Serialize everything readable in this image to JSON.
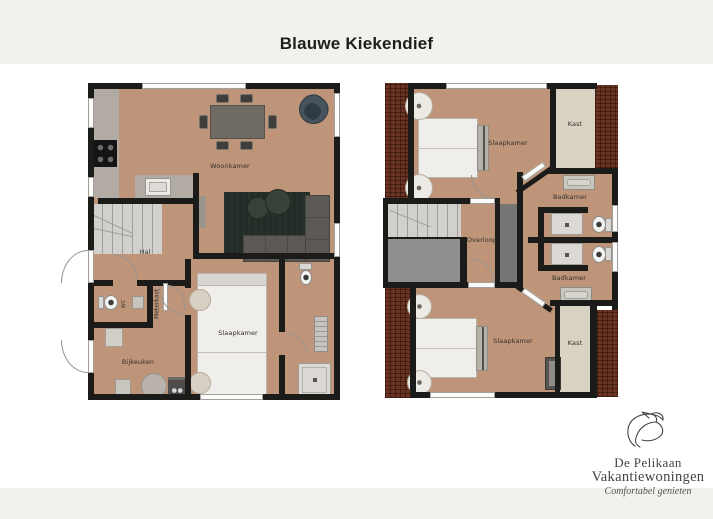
{
  "title": "Blauwe Kiekendief",
  "ground_floor": {
    "labels": {
      "woonkamer": "Woonkamer",
      "hal": "Hal",
      "wc": "WC",
      "meterkast": "Meterkast",
      "bijkeuken": "Bijkeuken",
      "slaapkamer": "Slaapkamer"
    }
  },
  "upper_floor": {
    "labels": {
      "slaapkamer_top": "Slaapkamer",
      "kast_top": "Kast",
      "badkamer_top": "Badkamer",
      "overloop": "Overloop",
      "badkamer_bottom": "Badkamer",
      "slaapkamer_bottom": "Slaapkamer",
      "kast_bottom": "Kast"
    }
  },
  "logo": {
    "icon": "pelican-line-art",
    "line1": "De Pelikaan",
    "line2": "Vakantiewoningen",
    "tagline": "Comfortabel genieten"
  },
  "colors": {
    "page_background": "#ffffff",
    "band": "#f3f1eb",
    "floor": "#bf9579",
    "wall": "#1b1b19",
    "roof_hatch": "#6b3322",
    "closet": "#d9d3c4",
    "rug": "#27312b",
    "sofa": "#5c5955",
    "accent_chair": "#46525c",
    "stairs": "#d2d0cd"
  }
}
